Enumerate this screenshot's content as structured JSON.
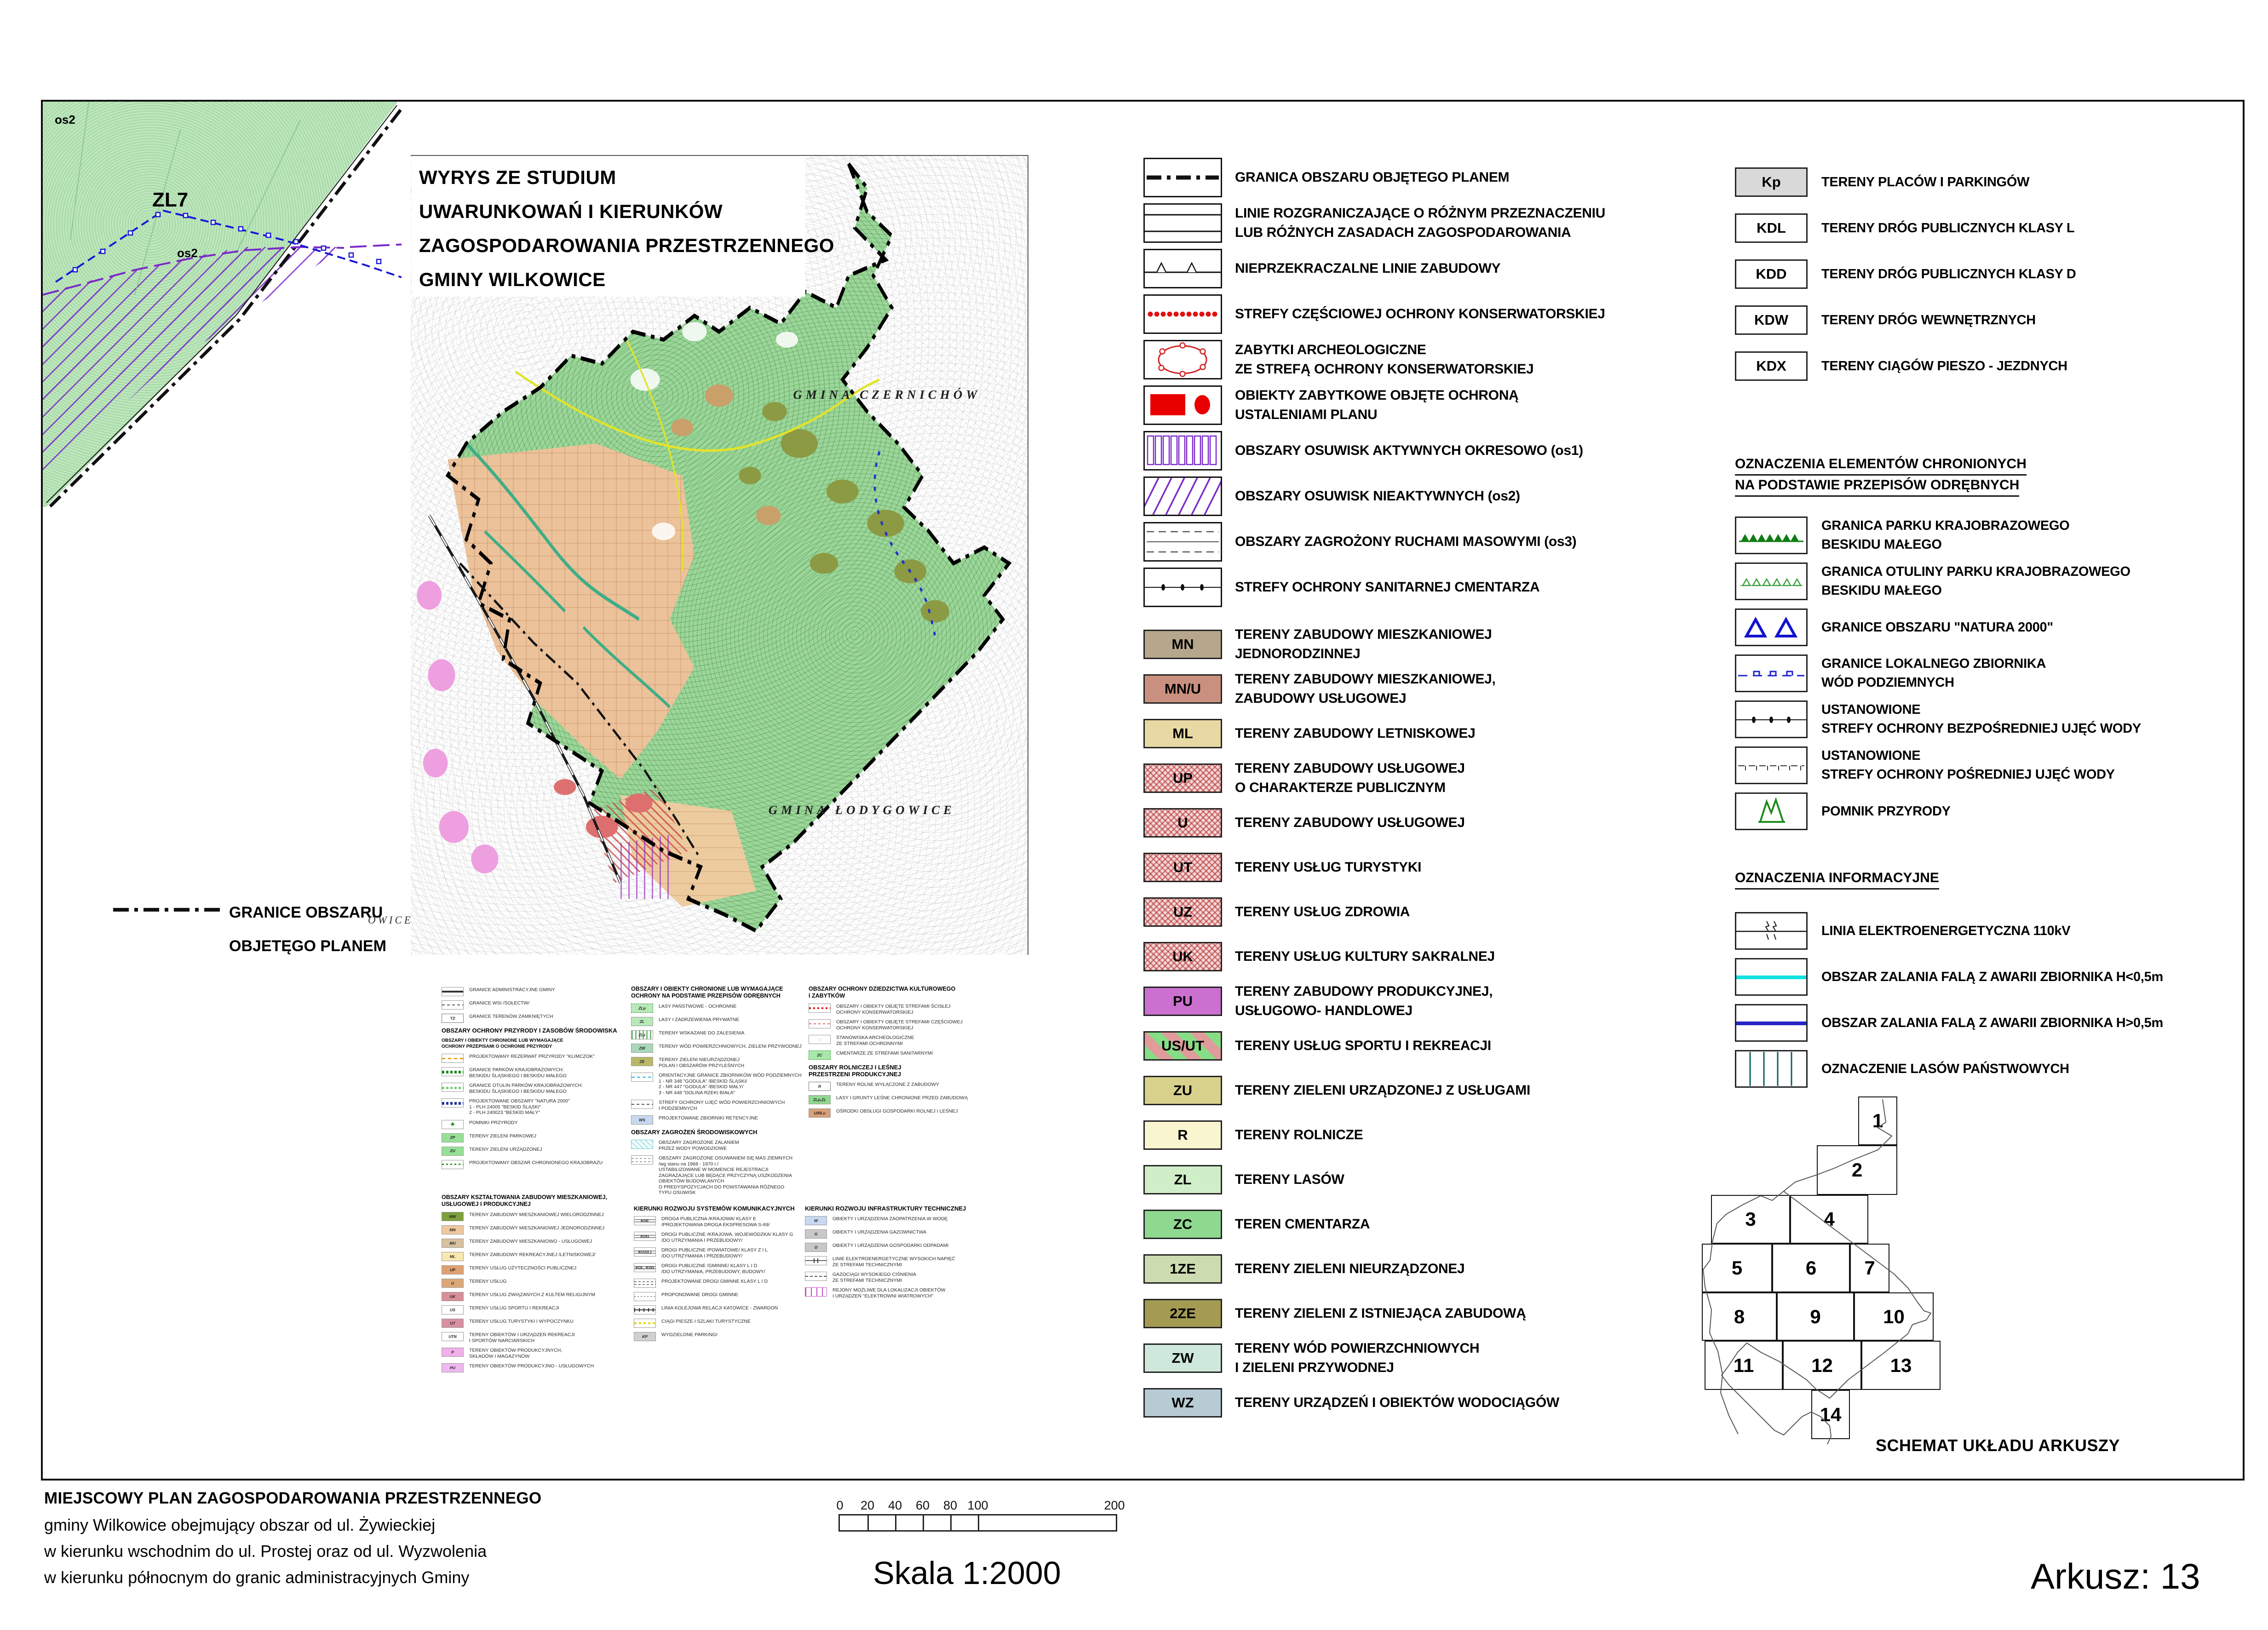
{
  "corner": {
    "zl7": "ZL7",
    "os2_top": "os2",
    "os2_mid": "os2"
  },
  "wyrys": {
    "lines": [
      "WYRYS ZE STUDIUM",
      "UWARUNKOWAŃ I KIERUNKÓW",
      "ZAGOSPODAROWANIA PRZESTRZENNEGO",
      "GMINY WILKOWICE"
    ]
  },
  "map": {
    "gmina1": "GMINA CZERNICHÓW",
    "gmina2": "GMINA ŁODYGOWICE",
    "edge_label": "OWICE"
  },
  "granice_note": {
    "text": "GRANICE OBSZARU\nOBJETĘGO PLANEM"
  },
  "legend": {
    "symbols": [
      {
        "icon": "dash-dot-line",
        "label": "GRANICA OBSZARU OBJĘTEGO PLANEM"
      },
      {
        "icon": "parallel-lines",
        "label": "LINIE ROZGRANICZAJĄCE O RÓŻNYM PRZEZNACZENIU\nLUB RÓŻNYCH ZASADACH ZAGOSPODAROWANIA"
      },
      {
        "icon": "line-with-triangles",
        "label": "NIEPRZEKRACZALNE LINIE ZABUDOWY"
      },
      {
        "icon": "red-dotted-line",
        "label": "STREFY CZĘŚCIOWEJ OCHRONY KONSERWATORSKIEJ"
      },
      {
        "icon": "red-circle-zone",
        "label": "ZABYTKI  ARCHEOLOGICZNE\nZE STREFĄ OCHRONY KONSERWATORSKIEJ"
      },
      {
        "icon": "red-rect-dot",
        "label": "OBIEKTY ZABYTKOWE OBJĘTE OCHRONĄ\nUSTALENIAMI PLANU"
      },
      {
        "icon": "purple-bars",
        "label": "OBSZARY OSUWISK AKTYWNYCH OKRESOWO (os1)"
      },
      {
        "icon": "purple-hatch",
        "label": "OBSZARY OSUWISK NIEAKTYWNYCH (os2)"
      },
      {
        "icon": "gray-dashes",
        "label": "OBSZARY ZAGROŻONY RUCHAMI MASOWYMI (os3)"
      },
      {
        "icon": "line-with-dots",
        "label": "STREFY OCHRONY SANITARNEJ CMENTARZA"
      }
    ],
    "zones": [
      {
        "code": "MN",
        "bg": "#b6a68c",
        "label": "TERENY ZABUDOWY MIESZKANIOWEJ\nJEDNORODZINNEJ"
      },
      {
        "code": "MN/U",
        "bg": "#c9907f",
        "label": "TERENY ZABUDOWY MIESZKANIOWEJ,\nZABUDOWY USŁUGOWEJ"
      },
      {
        "code": "ML",
        "bg": "#e8d9a4",
        "label": "TERENY ZABUDOWY LETNISKOWEJ"
      },
      {
        "code": "UP",
        "pat": "pat-hatch",
        "label": "TERENY ZABUDOWY USŁUGOWEJ\nO CHARAKTERZE PUBLICZNYM"
      },
      {
        "code": "U",
        "pat": "pat-hatch",
        "label": "TERENY ZABUDO­WY USŁUGOWEJ"
      },
      {
        "code": "UT",
        "pat": "pat-hatch",
        "label": "TERENY USŁUG TURYSTYKI"
      },
      {
        "code": "UZ",
        "pat": "pat-hatch",
        "label": "TERENY USŁUG ZDROWIA"
      },
      {
        "code": "UK",
        "pat": "pat-hatch",
        "label": "TERENY USŁUG KULTURY SAKRALNEJ"
      },
      {
        "code": "PU",
        "bg": "#cb70d0",
        "label": "TERENY ZABUDOWY PRODUKCYJNEJ,\nUSŁUGOWO- HANDLOWEJ"
      },
      {
        "code": "US/UT",
        "pat": "pat-us",
        "label": "TERENY USŁUG SPORTU I REKREACJI"
      },
      {
        "code": "ZU",
        "bg": "#d8d18c",
        "label": "TERENY ZIELENI URZĄDZONEJ  Z USŁUGAMI"
      },
      {
        "code": "R",
        "bg": "#f8f5cf",
        "label": "TERENY ROLNICZE"
      },
      {
        "code": "ZL",
        "bg": "#d0eec8",
        "label": "TERENY LASÓW"
      },
      {
        "code": "ZC",
        "bg": "#8fd890",
        "label": "TEREN CMENTARZA"
      },
      {
        "code": "1ZE",
        "bg": "#cddbb0",
        "label": "TERENY ZIELENI NIEURZĄDZONEJ"
      },
      {
        "code": "2ZE",
        "bg": "#a49a52",
        "label": "TERENY ZIELENI Z ISTNIEJĄCA ZABUDOWĄ"
      },
      {
        "code": "ZW",
        "bg": "#cfe8dc",
        "label": "TERENY WÓD POWIERZCHNIOWYCH\nI ZIELENI PRZYWODNEJ"
      },
      {
        "code": "WZ",
        "bg": "#b7cbd4",
        "label": "TERENY URZĄDZEŃ  I OBIEKTÓW WODOCIĄGÓW"
      }
    ]
  },
  "roads": {
    "items": [
      {
        "code": "Kp",
        "bg": "#d9d9d9",
        "label": "TERENY PLACÓW I PARKINGÓW"
      },
      {
        "code": "KDL",
        "bg": "#ffffff",
        "label": "TERENY DRÓG  PUBLICZNYCH KLASY L"
      },
      {
        "code": "KDD",
        "bg": "#ffffff",
        "label": "TERENY DRÓG  PUBLICZNYCH KLASY D"
      },
      {
        "code": "KDW",
        "bg": "#ffffff",
        "label": "TERENY DRÓG WEWNĘTRZNYCH"
      },
      {
        "code": "KDX",
        "bg": "#ffffff",
        "label": "TERENY CIĄGÓW PIESZO - JEZDNYCH"
      }
    ]
  },
  "protected": {
    "header1": "OZNACZENIA ELEMENTÓW CHRONIONYCH",
    "header2": "NA PODSTAWIE PRZEPISÓW ODRĘBNYCH",
    "items": [
      {
        "icon": "green-solid-triangles",
        "label": "GRANICA PARKU KRAJOBRAZOWEGO\nBESKIDU MAŁEGO"
      },
      {
        "icon": "green-open-triangles",
        "label": "GRANICA  OTULINY PARKU KRAJOBRAZOWEGO\nBESKIDU MAŁEGO"
      },
      {
        "icon": "blue-open-triangles",
        "label": "GRANICE OBSZARU \"NATURA 2000\""
      },
      {
        "icon": "blue-dash-squares",
        "label": "GRANICE LOKALNEGO ZBIORNIKA\nWÓD PODZIEMNYCH"
      },
      {
        "icon": "line-with-dots",
        "label": "USTANOWIONE\nSTREFY OCHRONY BEZPOŚREDNIEJ UJĘĆ WODY"
      },
      {
        "icon": "dash-with-ticks",
        "label": "USTANOWIONE\nSTREFY OCHRONY POŚREDNIEJ UJĘĆ WODY"
      },
      {
        "icon": "green-monument",
        "label": "POMNIK PRZYRODY"
      }
    ]
  },
  "info": {
    "header": "OZNACZENIA INFORMACYJNE",
    "items": [
      {
        "icon": "power-line",
        "label": "LINIA ELEKTROENERGETYCZNA 110kV"
      },
      {
        "icon": "cyan-line",
        "label": "OBSZAR ZALANIA FALĄ Z AWARII ZBIORNIKA H<0,5m"
      },
      {
        "icon": "blue-line",
        "label": "OBSZAR ZALANIA FALĄ Z AWARII ZBIORNIKA H>0,5m"
      },
      {
        "icon": "state-forest-box",
        "label": "OZNACZENIE LASÓW PAŃSTWOWYCH"
      }
    ]
  },
  "schemat": {
    "label": "SCHEMAT UKŁADU ARKUSZY",
    "sheets": [
      "1",
      "2",
      "3",
      "4",
      "5",
      "6",
      "7",
      "8",
      "9",
      "10",
      "11",
      "12",
      "13",
      "14"
    ]
  },
  "mini": {
    "a": {
      "items": [
        {
          "sym": "ms-thick",
          "t": "GRANICE ADMINISTRACYJNE GMINY"
        },
        {
          "sym": "ms-dash",
          "t": "GRANICE WSI /SOŁECTW/"
        },
        {
          "sym": "ms-code",
          "code": "TZ",
          "t": "GRANICE TERENÓW ZAMKNIĘTYCH"
        },
        {
          "cls": "mh",
          "t": "OBSZARY OCHRONY PRZYRODY I ZASOBÓW ŚRODOWISKA"
        },
        {
          "cls": "msub",
          "t": "OBSZARY I OBIEKTY CHRONIONE LUB WYMAGAJĄCE\nOCHRONY PRZEPISAMI O OCHRONIE PRZYRODY"
        },
        {
          "sym": "ms-dash-orange",
          "t": "PROJEKTOWANY  REZERWAT PRZYRODY \"KLIMCZOK\""
        },
        {
          "sym": "ms-tri-green",
          "t": "GRANICE PARKÓW KRAJOBRAZOWYCH:\nBESKIDU ŚLĄSKIEGO I BESKIDU MAŁEGO"
        },
        {
          "sym": "ms-tri-open",
          "t": "GRANICE OTULIN PARKÓW KRAJOBRAZOWYCH:\nBESKIDU ŚLĄSKIEGO I BESKIDU MAŁEGO"
        },
        {
          "sym": "ms-tri-navy",
          "t": "PROJEKTOWANE OBSZARY \"NATURA 2000\"\n1 - PLH 24005  \"BESKID ŚLĄSKI\"\n2 - PLH 240023  \"BESKID MAŁY\""
        },
        {
          "sym": "ms-trees",
          "code": "♣",
          "t": "POMNIKI PRZYRODY"
        },
        {
          "sym": "ms-chip",
          "bg": "#97e097",
          "code": "ZP",
          "t": "TERENY ZIELENI PARKOWEJ"
        },
        {
          "sym": "ms-chip",
          "bg": "#97e097",
          "code": "ZU",
          "t": "TERENY ZIELENI URZĄDZONEJ"
        },
        {
          "sym": "ms-dots-green",
          "t": "PROJEKTOWANY OBSZAR CHRONIONEGO KRAJOBRAZU"
        }
      ]
    },
    "b": {
      "items": [
        {
          "cls": "mh2",
          "t": "OBSZARY I OBIEKTY CHRONIONE LUB WYMAGAJĄCE\nOCHRONY NA PODSTAWIE PRZEPISÓW ODRĘBNYCH"
        },
        {
          "sym": "ms-chip ms-dashbrd",
          "bg": "#b9e8b9",
          "code": "ZLp",
          "t": "LASY PAŃSTWOWE - OCHRONNE"
        },
        {
          "sym": "ms-chip",
          "bg": "#b9e8b9",
          "code": "ZL",
          "t": "LASY I ZADRZEWIENIA PRYWATNE"
        },
        {
          "sym": "ms-stripes-v",
          "code": "ZLz",
          "t": "TERENY WSKAZANE DO ZALESIENIA"
        },
        {
          "sym": "ms-chip",
          "bg": "#a8d8b8",
          "code": "ZW",
          "t": "TERENY WÓD POWIERZCHNIOWYCH, ZIELENI PRZYWODNEJ"
        },
        {
          "sym": "ms-chip",
          "bg": "#b8b868",
          "code": "ZE",
          "t": "TERENY ZIELENI NIEURZĄDZONEJ\nPOLAN I OBSZARÓW PRZYLEŚNYCH"
        },
        {
          "sym": "ms-cyan-dash",
          "t": "ORIENTACYJNE GRANICE ZBIORNIKÓW WÓD PODZIEMNYCH\n1 - NR 348 \"GODULA\" /BESKID ŚLĄSKI/\n2 - NR 447 \"GODULA\" /BESKID MAŁY/\n3 - NR 448 \"DOLINA RZEKI BIAŁA\""
        },
        {
          "sym": "ms-dash",
          "t": "STREFY OCHRONY UJĘĆ WÓD POWIERZCHNIOWYCH\nI PODZIEMNYCH"
        },
        {
          "sym": "ms-chip",
          "bg": "#c8d8f0",
          "code": "WS",
          "t": "PROJEKTOWANE ZBIORNIKI RETENCYJNE"
        },
        {
          "cls": "mh",
          "t": "OBSZARY ZAGROŻEŃ ŚRODOWISKOWYCH"
        },
        {
          "sym": "ms-hatch-cyan",
          "t": "OBSZARY ZAGROŻONE ZALANIEM\nPRZEZ WODY POWODZIOWE"
        },
        {
          "sym": "ms-slide",
          "t": "OBSZARY ZAGROŻONE OSUWANIEM SIĘ MAS ZIEMNYCH\n/wg stanu na 1968 - 1970 r./\nUSTABILIZOWANE W MOMENCIE REJESTRACJI\nZAGRAŻAJĄCE LUB BĘDĄCE PRZYCZYNĄ USZKODZENIA\nOBIEKTÓW BUDOWLANYCH\nO PREDYSPOZYCJACH DO POWSTAWANIA RÓŻNEGO\nTYPU OSUWISK"
        }
      ]
    },
    "c": {
      "items": [
        {
          "cls": "mh2",
          "t": "OBSZARY OCHRONY DZIEDZICTWA KULTUROWEGO\nI ZABYTKÓW"
        },
        {
          "sym": "ms-dots-red",
          "t": "OBSZARY I OBIEKTY OBJĘTE STREFAMI ŚCISŁEJ\nOCHRONY KONSERWATORSKIEJ"
        },
        {
          "sym": "ms-dash-red",
          "t": "OBSZARY I OBIEKTY OBJĘTE STREFAMI CZĘŚCIOWEJ\nOCHRONY KONSERWATORSKIEJ"
        },
        {
          "sym": "ms-circle",
          "code": "◌",
          "t": "STANOWISKA ARCHEOLOGICZNE\nZE STREFAMI OCHRONNYMI"
        },
        {
          "sym": "ms-chip ms-dashbrd",
          "bg": "#a8e8a8",
          "code": "ZC",
          "t": "CMENTARZE ZE STREFAMI SANITARNYMI"
        },
        {
          "cls": "mh",
          "t": "OBSZARY ROLNICZEJ I LEŚNEJ\nPRZESTRZENI PRODUKCYJNEJ"
        },
        {
          "sym": "ms-code",
          "code": "R",
          "t": "TERENY ROLNE WYŁĄCZONE Z ZABUDOWY"
        },
        {
          "sym": "ms-chip",
          "bg": "#90d890",
          "code": "ZLp,ZL",
          "t": "LASY I GRUNTY LEŚNE CHRONIONE PRZED ZABUDOWĄ"
        },
        {
          "sym": "ms-chip",
          "bg": "#d8a078",
          "code": "U/RLu",
          "t": "OŚRODKI OBSŁUGI GOSPODARKI ROLNEJ I LEŚNEJ"
        }
      ]
    },
    "d": {
      "items": [
        {
          "cls": "mh2",
          "t": "OBSZARY KSZTAŁTOWANIA ZABUDOWY MIESZKANIOWEJ,\nUSŁUGOWEJ I PRODUKCYJNEJ"
        },
        {
          "sym": "ms-chip",
          "bg": "#7da03c",
          "code": "MW",
          "t": "TERENY ZABUDOWY MIESZKANIOWEJ WIELORODZINNEJ"
        },
        {
          "sym": "ms-chip",
          "bg": "#f0c8a0",
          "code": "MN",
          "t": "TERENY ZABUDOWY MIESZKANIOWEJ  JEDNORODZINNEJ"
        },
        {
          "sym": "ms-chip",
          "bg": "#d8c0a0",
          "code": "MU",
          "t": "TERENY ZABUDOWY MIESZKANIOWO - USŁUGOWEJ"
        },
        {
          "sym": "ms-chip",
          "bg": "#f8e8b0",
          "code": "ML",
          "t": "TERENY ZABUDOWY REKREACYJNEJ /LETNISKOWEJ/"
        },
        {
          "sym": "ms-chip",
          "bg": "#e0a070",
          "code": "UP",
          "t": "TERENY USŁUG UŻYTECZNOŚCI PUBLICZNEJ"
        },
        {
          "sym": "ms-chip",
          "bg": "#dca878",
          "code": "U",
          "t": "TERENY USŁUG"
        },
        {
          "sym": "ms-chip",
          "bg": "#d89098",
          "code": "UK",
          "t": "TERENY USŁUG ZWIĄZANYCH Z KULTEM RELIGIJNYM"
        },
        {
          "sym": "ms-us",
          "code": "US",
          "t": "TERENY USŁUG SPORTU I REKREACJI"
        },
        {
          "sym": "ms-chip",
          "bg": "#d890a0",
          "code": "UT",
          "t": "TERENY USŁUG TURYSTYKI I WYPOCZYNKU"
        },
        {
          "sym": "ms-us",
          "code": "UTN",
          "t": "TERENY OBIEKTÓW I URZĄDZEŃ REKREACJI\nI SPORTÓW NARCIARSKICH"
        },
        {
          "sym": "ms-chip",
          "bg": "#f0b0e8",
          "code": "P",
          "t": "TERENY OBIEKTÓW PRODUKCYJNYCH,\nSKŁADÓW I MAGAZYNÓW"
        },
        {
          "sym": "ms-chip",
          "bg": "#f0b8f0",
          "code": "PU",
          "t": "TERENY OBIEKTÓW PRODUKCYJNO - USŁUGOWYCH"
        }
      ]
    },
    "e": {
      "items": [
        {
          "cls": "mh",
          "t": "KIERUNKI ROZWOJU SYSTEMÓW KOMUNIKACYJNYCH"
        },
        {
          "sym": "ms-road",
          "code": "KDE",
          "t": "DROGA PUBLICZNA /KRAJOWA/ KLASY E\n/PROJEKTOWANA DROGA EKSPRESOWA S-69/"
        },
        {
          "sym": "ms-road",
          "code": "KDG",
          "t": "DROGI PUBLICZNE /KRAJOWA, WOJEWÓDZKA/ KLASY G\n/DO UTRZYMANIA I PRZEBUDOWY/"
        },
        {
          "sym": "ms-road",
          "code": "KDZ(L)",
          "t": "DROGI PUBLICZNE /POWIATOWE/ KLASY Z I L\n/DO UTRZYMANIA I PRZEBUDOWY/"
        },
        {
          "sym": "ms-road",
          "code": "KDL, KDD",
          "t": "DROGI PUBLICZNE /GMINNE/ KLASY L I D\n/DO UTRZYMANIA, PRZEBUDOWY, BUDOWY/"
        },
        {
          "sym": "ms-road-dash",
          "t": "PROJEKTOWANE DROGI GMINNE KLASY L I D"
        },
        {
          "sym": "ms-road-dot",
          "t": "PROPONOWANE DROGI GMINNE"
        },
        {
          "sym": "ms-rail",
          "t": "LINIA KOLEJOWA RELACJI KATOWICE - ZWARDOŃ"
        },
        {
          "sym": "ms-dots-yellow",
          "t": "CIĄGI PIESZE I SZLAKI TURYSTYCZNE"
        },
        {
          "sym": "ms-chip",
          "bg": "#d0d0d0",
          "code": "KP",
          "t": "WYDZIELONE PARKINGI"
        }
      ]
    },
    "f": {
      "items": [
        {
          "cls": "mh",
          "t": "KIERUNKI ROZWOJU INFRASTRUKTURY TECHNICZNEJ"
        },
        {
          "sym": "ms-chip",
          "bg": "#c8d8f0",
          "code": "W",
          "t": "OBIEKTY I URZĄDZENIA ZAOPATRZENIA W WODĘ"
        },
        {
          "sym": "ms-chip",
          "bg": "#c8c8c8",
          "code": "G",
          "t": "OBIEKTY I URZĄDZENIA GAZOWNICTWA"
        },
        {
          "sym": "ms-chip",
          "bg": "#c8c8c8",
          "code": "O",
          "t": "OBIEKTY I URZĄDZENIA GOSPODARKI ODPADAMI"
        },
        {
          "sym": "ms-power",
          "t": "LINIE ELEKTROENERGETYCZNE WYSOKICH NAPIĘĆ\nZE STREFAMI TECHNICZNYMI"
        },
        {
          "sym": "ms-gas",
          "t": "GAZOCIĄGI WYSOKIEGO CIŚNIENIA\nZE STREFAMI TECHNICZNYMI"
        },
        {
          "sym": "ms-wind",
          "t": "REJONY MOŻLIWE DLA LOKALIZACJI OBIEKTÓW\nI URZĄDZEŃ \"ELEKTROWNI WIATROWYCH\""
        }
      ]
    }
  },
  "scalebar": {
    "ticks": [
      "0",
      "20",
      "40",
      "60",
      "80",
      "100",
      "200"
    ]
  },
  "skala": "Skala 1:2000",
  "arkusz": "Arkusz: 13",
  "footer": {
    "lines": [
      "MIEJSCOWY PLAN ZAGOSPODAROWANIA PRZESTRZENNEGO",
      "gminy Wilkowice    obejmujący obszar od ul. Żywieckiej",
      "w kierunku wschodnim  do ul. Prostej oraz od ul. Wyzwolenia",
      "w kierunku północnym do granic  administracyjnych Gminy"
    ]
  }
}
